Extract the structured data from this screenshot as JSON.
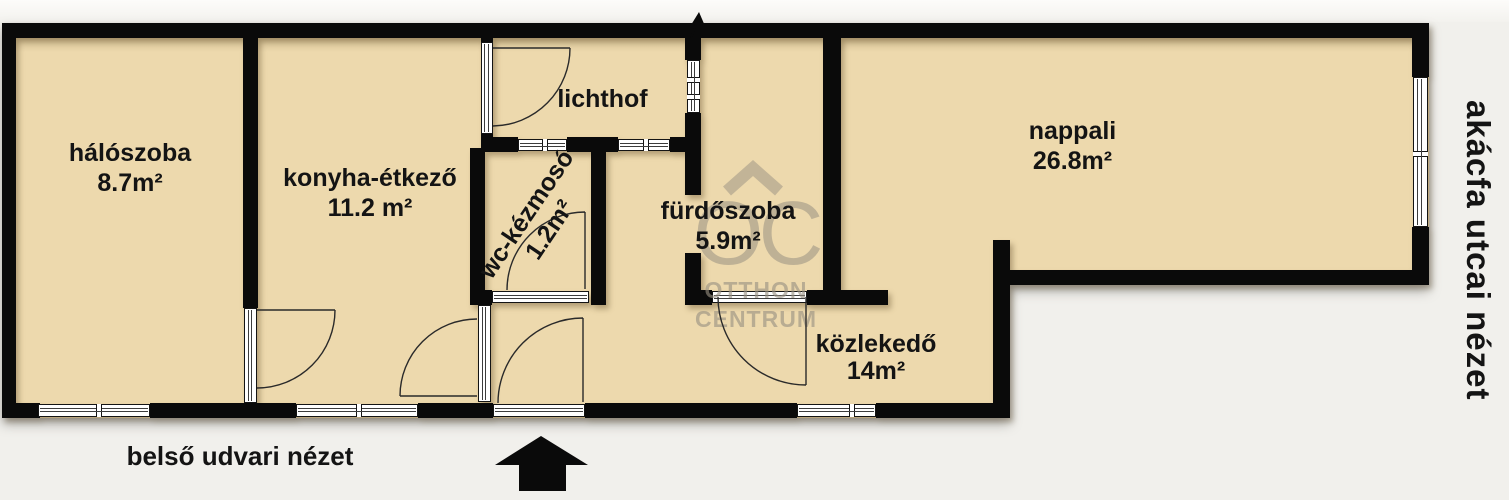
{
  "plan": {
    "rooms": [
      {
        "label": "hálószoba",
        "area": "8.7m²"
      },
      {
        "label": "konyha-étkező",
        "area": "11.2 m²"
      },
      {
        "label": "lichthof",
        "area": ""
      },
      {
        "label": "wc-kézmosó",
        "area": "1.2m²"
      },
      {
        "label": "fürdőszoba",
        "area": "5.9m²"
      },
      {
        "label": "nappali",
        "area": "26.8m²"
      },
      {
        "label": "közlekedő",
        "area": "14m²"
      }
    ],
    "captions": {
      "bottom": "belső udvari nézet",
      "right": "akácfa utcai nézet"
    },
    "watermark": {
      "monogram": "OC",
      "line1": "OTTHON",
      "line2": "CENTRUM"
    },
    "colors": {
      "floor": "#edd9ad",
      "wall": "#0a0a0a",
      "background": "#f1f0ec",
      "watermark": "#988f81"
    }
  }
}
